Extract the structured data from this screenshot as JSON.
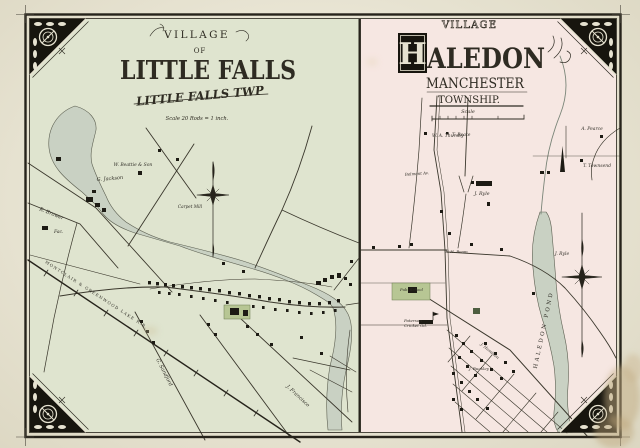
{
  "page": {
    "paper_color": "#e9e5d4",
    "ink_color": "#2e2b22",
    "left_panel_tint": "#dfe4cf",
    "right_panel_tint": "#f6e7e2",
    "water_color": "#c9d1c3",
    "parcel_green": "#b7c694"
  },
  "left_map": {
    "title_village": "VILLAGE",
    "title_of": "OF",
    "title_name": "LITTLE FALLS",
    "title_township": "LITTLE FALLS TWP",
    "scale_note": "Scale 20 Rods = 1 inch.",
    "railroad_label": "MONTCLAIR & GREENWOOD LAKE R.R.",
    "owners": [
      "G. Jackson",
      "W. Beattie & Son",
      "R. Brower",
      "G. Sandford",
      "J. Francisco"
    ],
    "places": [
      "Fac.",
      "Carpet Mill"
    ]
  },
  "right_map": {
    "title_village": "VILLAGE",
    "title_initial": "H",
    "title_name_rest": "ALEDON",
    "title_township_1": "MANCHESTER",
    "title_township_2": "TOWNSHIP.",
    "scale_note": "Scale",
    "pond_label": "HALEDON POND",
    "owners": [
      "W. A. Thursby",
      "T. Roate",
      "J. Ryle",
      "T. Townsend",
      "A. Pearce",
      "J. Ryle",
      "W. H. Beam",
      "J. Hamilton",
      "J. Buckley"
    ],
    "places": [
      "Belmont Av.",
      "Pub. School",
      "Paterson",
      "Cricket Gd."
    ]
  }
}
